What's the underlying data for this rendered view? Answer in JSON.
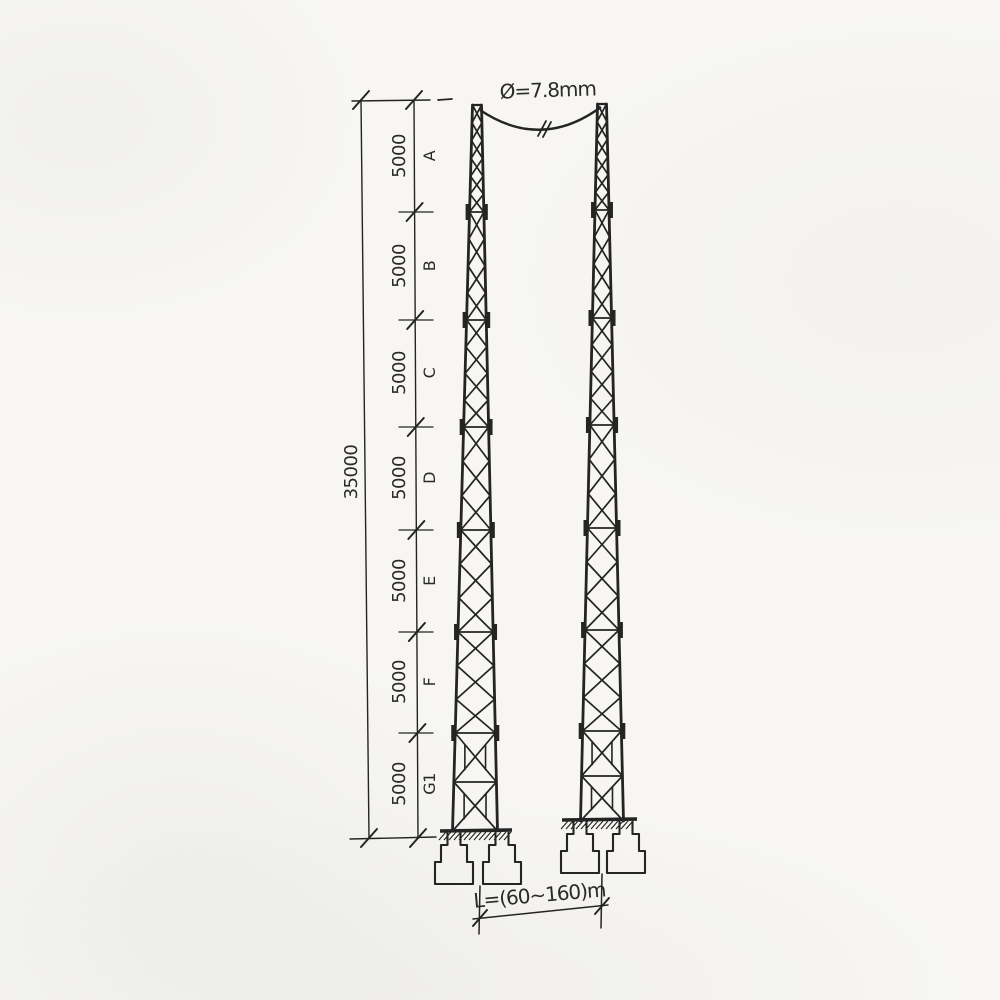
{
  "colors": {
    "ink": "#242424",
    "paper": "#f7f6f3"
  },
  "labels": {
    "conductor_diameter": "Ø=7.8mm",
    "span_length": "L=(60~160)m",
    "total_height": "35000"
  },
  "segments": [
    {
      "len": "5000",
      "name": "A"
    },
    {
      "len": "5000",
      "name": "B"
    },
    {
      "len": "5000",
      "name": "C"
    },
    {
      "len": "5000",
      "name": "D"
    },
    {
      "len": "5000",
      "name": "E"
    },
    {
      "len": "5000",
      "name": "F"
    },
    {
      "len": "5000",
      "name": "G1"
    }
  ],
  "diagram": {
    "dimension_chain": {
      "outer_line": [
        361,
        100,
        369,
        838
      ],
      "inner_line": [
        414,
        100,
        418,
        838
      ],
      "top_ext": [
        352,
        101,
        430,
        100
      ],
      "top_ext_dash": [
        438,
        100,
        452,
        99
      ],
      "bottom_ext": [
        350,
        839,
        436,
        837
      ],
      "boundaries_y": [
        212,
        320,
        427,
        530,
        632,
        733
      ],
      "boundary_x": [
        399,
        433
      ],
      "end_ticks_y": [
        100,
        838
      ]
    },
    "towers": [
      {
        "top_cx": 477,
        "top_y": 105,
        "top_hw": 4.5,
        "base_cx": 475,
        "base_y": 831,
        "base_hw": 22.5,
        "section_ys": [
          105,
          212,
          320,
          427,
          530,
          632,
          733,
          831
        ],
        "panels": [
          6,
          4,
          4,
          3,
          3,
          3
        ]
      },
      {
        "top_cx": 602,
        "top_y": 104,
        "top_hw": 4.5,
        "base_cx": 602,
        "base_y": 821,
        "base_hw": 21.5,
        "section_ys": [
          104,
          210,
          318,
          425,
          528,
          630,
          731,
          821
        ],
        "panels": [
          6,
          4,
          4,
          3,
          3,
          3
        ]
      }
    ],
    "grounds": [
      {
        "x1": 440,
        "x2": 512,
        "y": 831
      },
      {
        "x1": 562,
        "x2": 637,
        "y": 820
      }
    ],
    "foundations": {
      "half_widths": [
        6.5,
        13,
        19
      ],
      "heights": [
        13,
        17,
        22
      ],
      "items": [
        {
          "cx": 454,
          "top": 832
        },
        {
          "cx": 502,
          "top": 832
        },
        {
          "cx": 580,
          "top": 821
        },
        {
          "cx": 626,
          "top": 821
        }
      ]
    },
    "cable": {
      "path": "M 480 110 Q 541 151 601 107",
      "break_marks": [
        [
          538,
          136,
          546,
          121
        ],
        [
          543,
          137,
          551,
          122
        ]
      ]
    },
    "span_dimension": {
      "ext_left": [
        480,
        886,
        479,
        934
      ],
      "ext_right": [
        602,
        874,
        601,
        928
      ],
      "line": [
        473,
        919,
        608,
        905
      ],
      "ticks": [
        [
          480,
          918
        ],
        [
          602,
          906
        ]
      ]
    }
  }
}
